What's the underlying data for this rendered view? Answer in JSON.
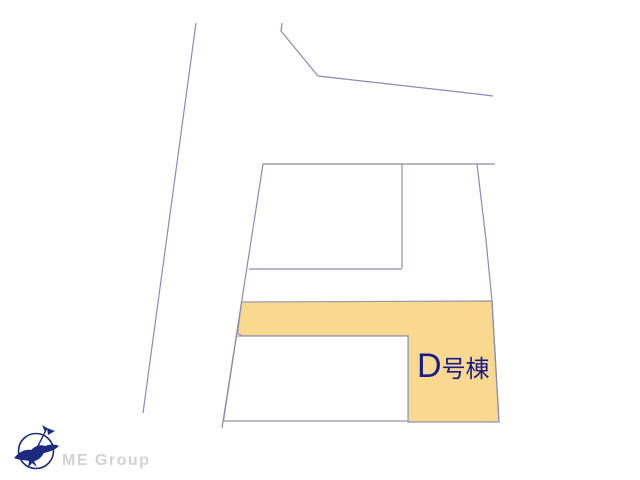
{
  "plot": {
    "label": "D号棟",
    "label_letter": "D",
    "label_suffix": "号棟"
  },
  "brand": {
    "name": "ME Group",
    "logo_icon": "compass-bird-logo"
  },
  "colors": {
    "background": "#FFFFFF",
    "boundary_line": "#8B8BB3",
    "highlight_fill": "#F8D98F",
    "label_text": "#1B1B8C",
    "brand_navy": "#1D2B7E",
    "brand_text": "#D2D2D2"
  }
}
